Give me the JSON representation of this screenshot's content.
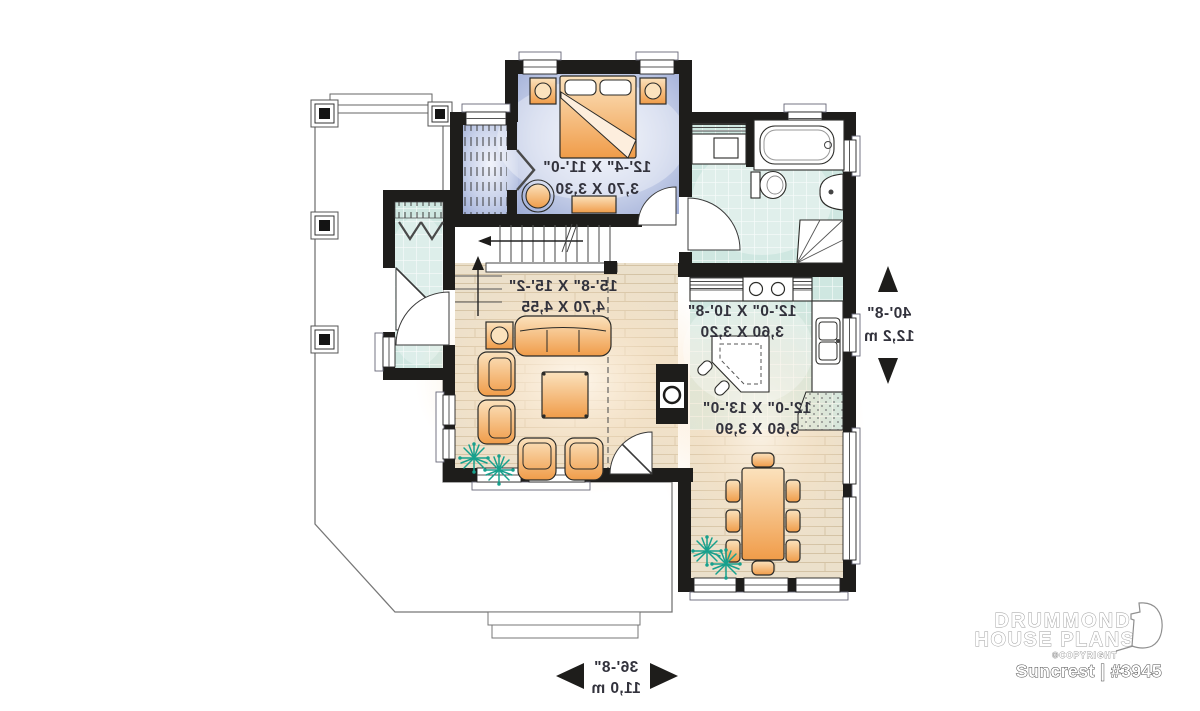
{
  "floor_plan": {
    "text_mirrored": true,
    "rooms": {
      "bedroom": {
        "imperial": "12'-4\" X 11'-0\"",
        "metric": "3,70 X 3,30"
      },
      "living_room": {
        "imperial": "15'-8\" X 15'-2\"",
        "metric": "4,70 X 4,55"
      },
      "kitchen": {
        "imperial": "12'-0\" X 10'-8\"",
        "metric": "3,60 X 3,20"
      },
      "dining_room": {
        "imperial": "12'-0\" X 13'-0\"",
        "metric": "3,60 X 3,90"
      }
    },
    "overall_dimensions": {
      "depth": {
        "imperial": "40'-8\"",
        "metric": "12,2 m"
      },
      "width": {
        "imperial": "36'-8\"",
        "metric": "11,0 m"
      }
    }
  },
  "branding": {
    "name_line1": "DRUMMOND",
    "name_line2": "HOUSE PLANS",
    "copyright": "©COPYRIGHT",
    "plan_title": "Suncrest | #3945"
  },
  "colors": {
    "wall": "#1e1d1b",
    "tile": "#cfe7e1",
    "wood": "#ebe0cb",
    "bedroom_floor": "#a4b1d8",
    "furniture_orange": "#f09c49",
    "plant_green": "#17a08d",
    "label_text": "#32323c"
  }
}
